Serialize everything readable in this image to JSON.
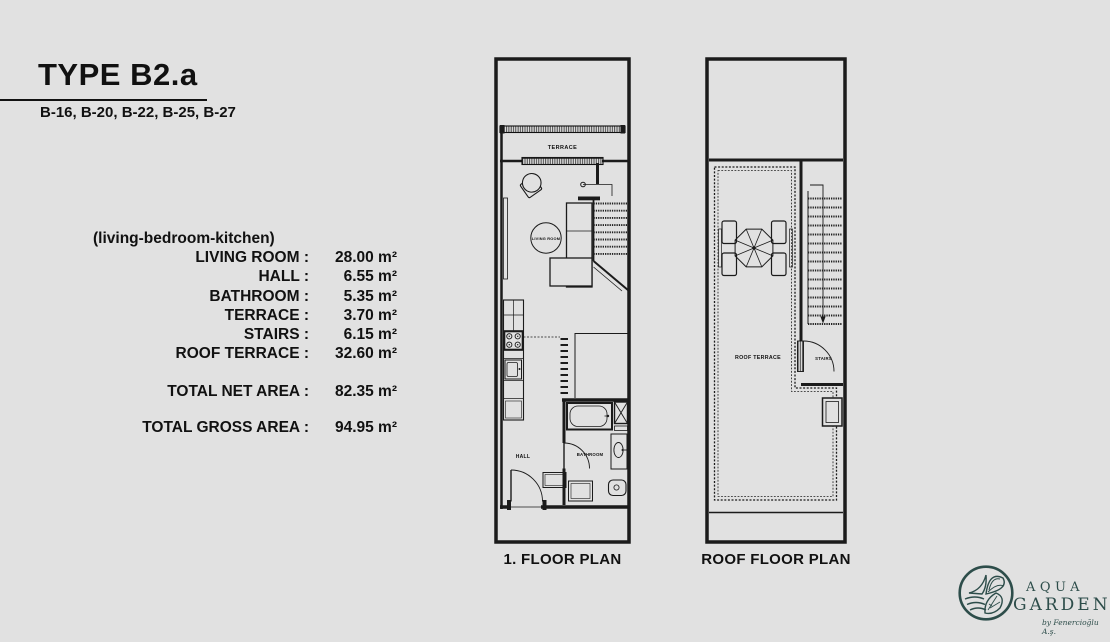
{
  "colors": {
    "background": "#e1e1e1",
    "ink": "#111111",
    "logo_teal": "#2d4d4a"
  },
  "header": {
    "title": "TYPE B2.a",
    "units": "B-16, B-20, B-22, B-25, B-27"
  },
  "areas": {
    "subtitle": "(living-bedroom-kitchen)",
    "rows": [
      {
        "label": "LIVING ROOM :",
        "value": "28.00 m²"
      },
      {
        "label": "HALL :",
        "value": "6.55 m²"
      },
      {
        "label": "BATHROOM :",
        "value": "5.35 m²"
      },
      {
        "label": "TERRACE :",
        "value": "3.70 m²"
      },
      {
        "label": "STAIRS :",
        "value": "6.15 m²"
      },
      {
        "label": "ROOF TERRACE :",
        "value": "32.60 m²"
      }
    ],
    "total_net": {
      "label": "TOTAL NET AREA :",
      "value": "82.35 m²"
    },
    "total_gross": {
      "label": "TOTAL GROSS AREA :",
      "value": "94.95 m²"
    }
  },
  "plans": {
    "first": {
      "caption": "1. FLOOR PLAN",
      "labels": {
        "terrace": "TERRACE",
        "living_room": "LIVING ROOM",
        "hall": "HALL",
        "bathroom": "BATHROOM"
      }
    },
    "roof": {
      "caption": "ROOF FLOOR PLAN",
      "labels": {
        "roof_terrace": "ROOF TERRACE",
        "stairs": "STAIRS"
      }
    }
  },
  "logo": {
    "line1": "AQUA",
    "line2": "GARDEN",
    "byline": "by Fenercioğlu A.ş."
  }
}
